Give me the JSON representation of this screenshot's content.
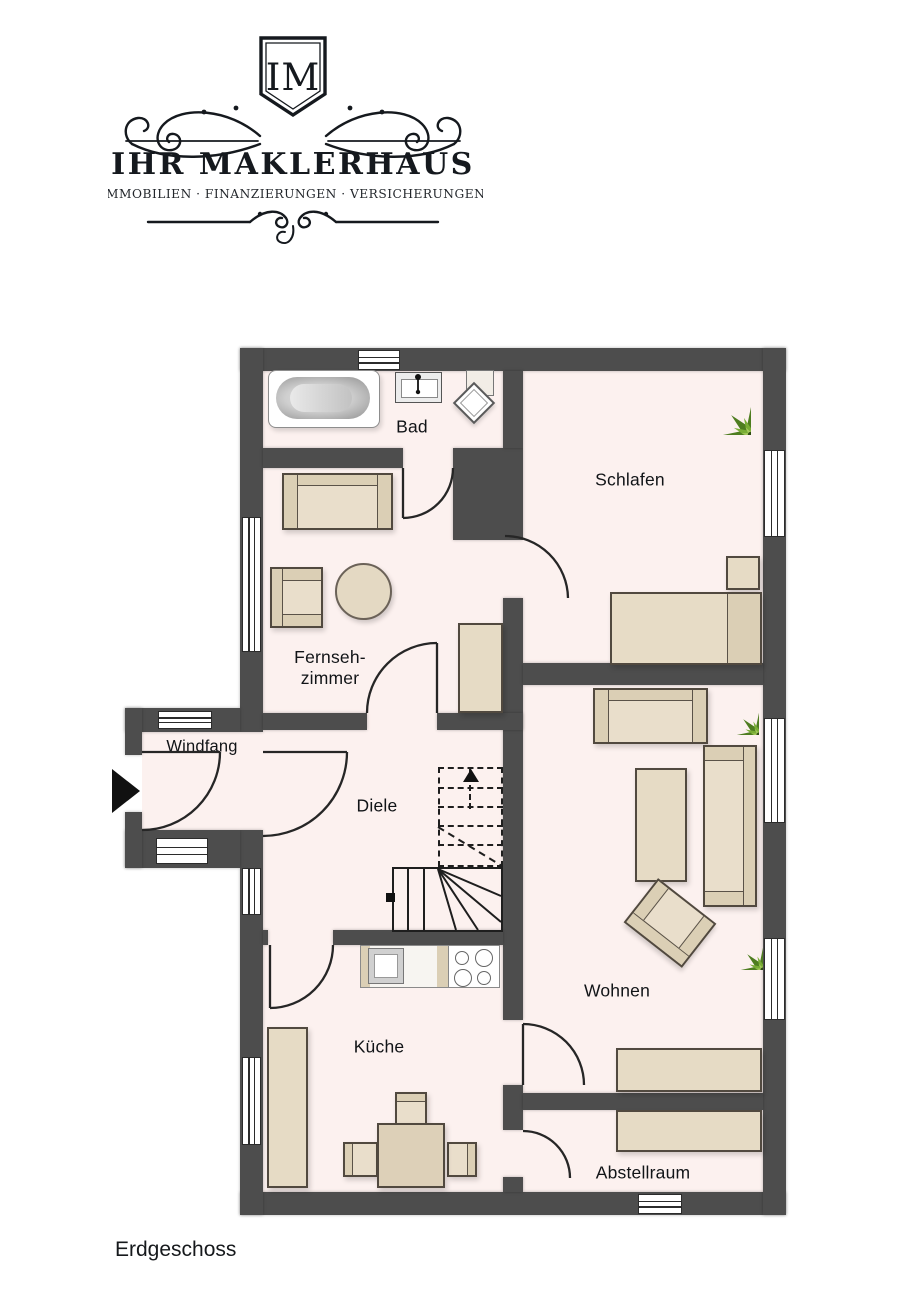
{
  "logo": {
    "monogram": "IM",
    "company": "IHR MAKLERHAUS",
    "tagline": "IMMOBILIEN · FINANZIERUNGEN · VERSICHERUNGEN"
  },
  "plan": {
    "floor_label": "Erdgeschoss",
    "rooms": {
      "bad": "Bad",
      "schlafen": "Schlafen",
      "fernsehzimmer": "Fernseh-\nzimmer",
      "windfang": "Windfang",
      "diele": "Diele",
      "wohnen": "Wohnen",
      "kueche": "Küche",
      "abstellraum": "Abstellraum"
    },
    "furniture": [
      "bathtub",
      "sink",
      "shower",
      "bed",
      "nightstand",
      "sofa",
      "armchair",
      "round-table",
      "coffee-table",
      "cabinet",
      "sideboard",
      "shelf",
      "kitchen-counter",
      "stove",
      "dining-table",
      "chair",
      "staircase",
      "plant",
      "entry-arrow"
    ],
    "colors": {
      "wall": "#4d4d4d",
      "floor": "#fcf1ef",
      "furniture": "#e6dbc5",
      "furniture_accent": "#dbcfb5",
      "plant_green": "#6da02c",
      "ink": "#15191e"
    }
  }
}
